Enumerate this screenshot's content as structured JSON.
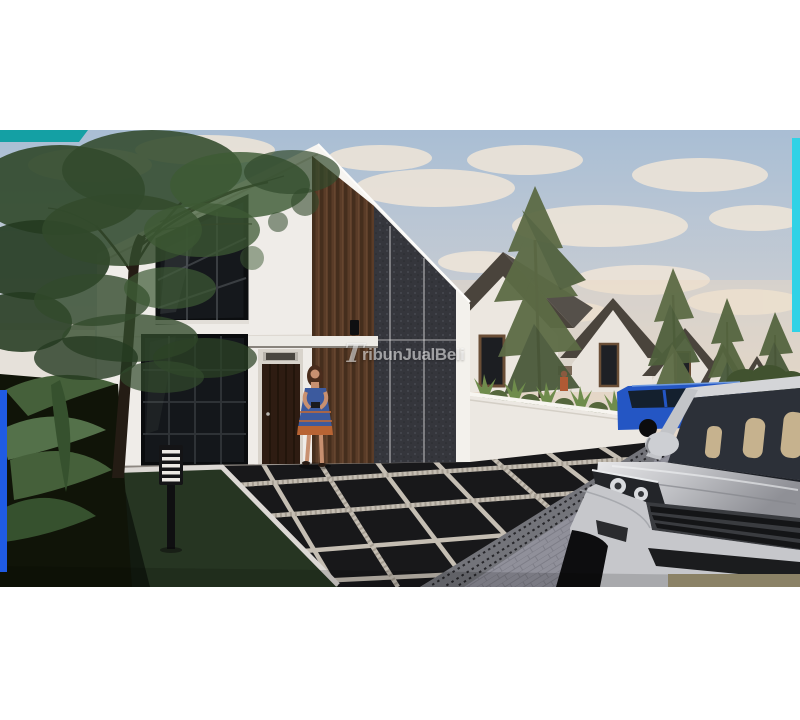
{
  "window": {
    "width": 800,
    "height": 720
  },
  "watermark": {
    "initial": "T",
    "rest": "ribunJualBeli",
    "full_text": "TribunJualBeli",
    "color": "#ffffff",
    "opacity": 0.55
  },
  "photo": {
    "type": "3d-architectural-render",
    "subject": "Modern minimalist two-story white house with dark wood slat and stone accents, woman standing at the entrance, black tiled driveway, row of similar houses with pine trees, parked blue car and silver SUV in the foreground",
    "letterbox": {
      "top_bar_px": 130,
      "bottom_bar_px": 133,
      "photo_height_px": 457
    }
  },
  "accents": {
    "teal_bar_top_left": "#14a0a4",
    "cyan_strip_right": "#30d2e6",
    "blue_strip_left": "#1f5be4",
    "bottom_tan_strip": "#8b8266"
  },
  "palette": {
    "sky_top": "#a9bed4",
    "sky_mid": "#c9cdd3",
    "sky_warm": "#e6d8c8",
    "cloud": "#f0e6d8",
    "house_wall": "#efece8",
    "fascia": "#f7f5f1",
    "wood_slats": "#5a3c28",
    "stone_wall": "#35363c",
    "roof_dark": "#4a443c",
    "bg_house_wall": "#ece7e0",
    "door": "#2e1c12",
    "window_glass": "#15181c",
    "tree_foliage": "#324a2c",
    "pine": "#5c6b45",
    "plant": "#45603a",
    "grass": "#263522",
    "tile": "#18181a",
    "tile_joint": "#cfc8bc",
    "street": "#90909a",
    "grate": "#73747a",
    "curb": "#dcd8d4",
    "fence": "#ece8e2",
    "suv_body": "#c6c7cb",
    "suv_glass": "#2c3038",
    "seat": "#c6b28e",
    "blue_car": "#2456c4",
    "dress": "#3c5a9e",
    "dress_hem": "#b86434",
    "skin": "#c89070",
    "hair": "#4a2c1c"
  }
}
